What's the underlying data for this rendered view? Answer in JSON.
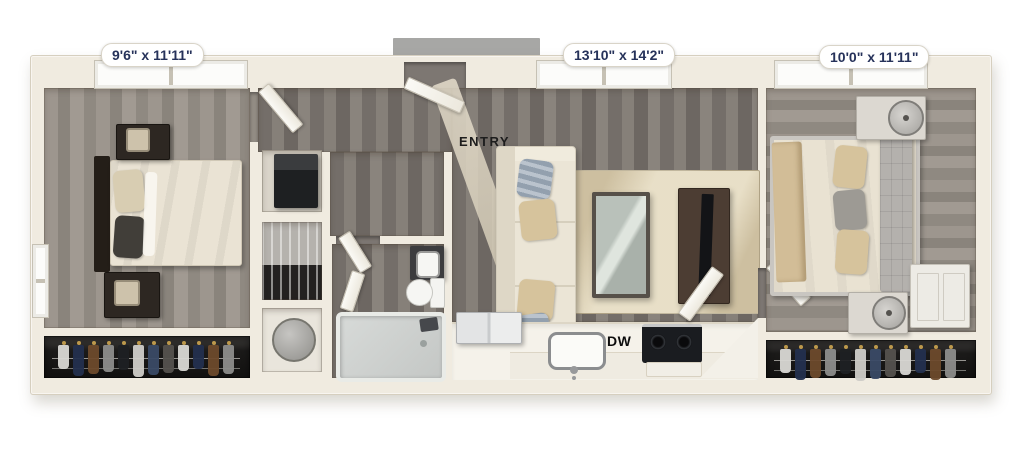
{
  "labels": {
    "bedroom1_dims": "9'6\" x 11'11\"",
    "living_dims": "13'10\" x 14'2\"",
    "bedroom2_dims": "10'0\" x 11'11\"",
    "entry": "ENTRY",
    "dishwasher": "DW"
  },
  "colors": {
    "label_text": "#26325a",
    "wall": "#f0ebe0",
    "floor_living": "#7d7772",
    "floor_bedroom": "#938d85",
    "rug": "#cdbfa0",
    "closet_interior": "#1b1a19",
    "kitchen_counter": "#f5f2ea",
    "range_top": "#1a1c20",
    "entry_stoop": "#a7a7a5"
  },
  "closet": {
    "clothes_colors": [
      "#d9d8d4",
      "#23304e",
      "#6d4a2c",
      "#8d8d8b",
      "#1e2023",
      "#cfcdc8",
      "#3a4a66",
      "#55524e"
    ]
  }
}
